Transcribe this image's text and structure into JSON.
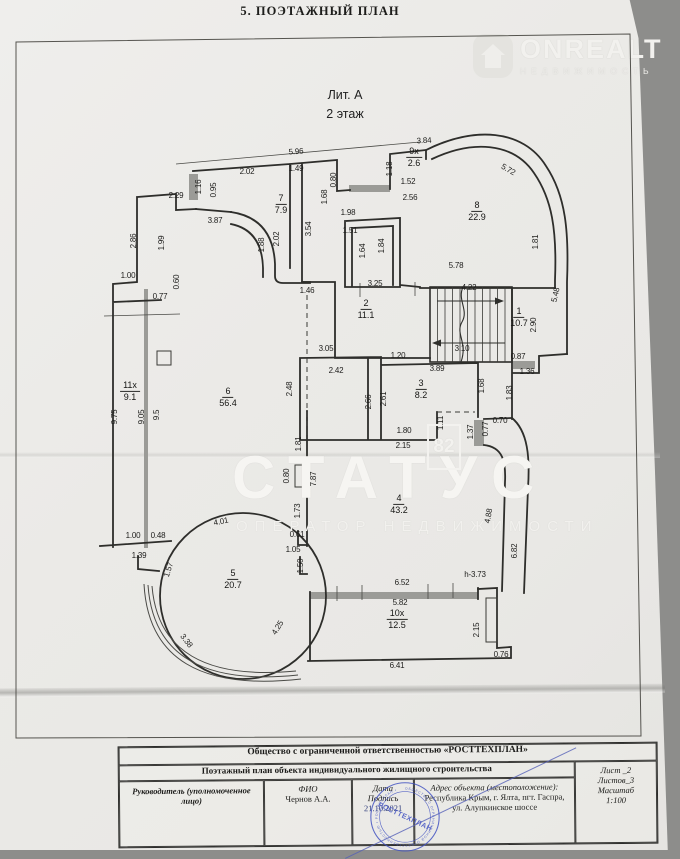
{
  "header": {
    "title": "5. ПОЭТАЖНЫЙ ПЛАН"
  },
  "watermarks": {
    "onrealt_brand": "ONREALT",
    "onrealt_sub": "НЕДВИЖИМОСТЬ",
    "status_brand": "СТАТУС",
    "status_sub": "ОПЕРАТОР НЕДВИЖИМОСТИ",
    "badge_82": "82"
  },
  "plan": {
    "litera": "Лит. А",
    "floor": "2 этаж",
    "rooms": [
      {
        "num": "1",
        "area": "10.7",
        "x": 519,
        "y": 317
      },
      {
        "num": "2",
        "area": "11.1",
        "x": 366,
        "y": 309
      },
      {
        "num": "3",
        "area": "8.2",
        "x": 421,
        "y": 389
      },
      {
        "num": "4",
        "area": "43.2",
        "x": 399,
        "y": 504
      },
      {
        "num": "5",
        "area": "20.7",
        "x": 233,
        "y": 579
      },
      {
        "num": "6",
        "area": "56.4",
        "x": 228,
        "y": 397
      },
      {
        "num": "7",
        "area": "7.9",
        "x": 281,
        "y": 204
      },
      {
        "num": "8",
        "area": "22.9",
        "x": 477,
        "y": 211
      },
      {
        "num": "9x",
        "area": "2.6",
        "x": 414,
        "y": 157
      },
      {
        "num": "10x",
        "area": "12.5",
        "x": 397,
        "y": 619
      },
      {
        "num": "11x",
        "area": "9.1",
        "x": 130,
        "y": 391
      }
    ],
    "dimensions": [
      {
        "t": "5.96",
        "x": 296,
        "y": 152,
        "r": -4
      },
      {
        "t": "3.84",
        "x": 424,
        "y": 141,
        "r": -3
      },
      {
        "t": "2.29",
        "x": 176,
        "y": 196
      },
      {
        "t": "1.16",
        "x": 199,
        "y": 187,
        "r": -90
      },
      {
        "t": "0.95",
        "x": 214,
        "y": 190,
        "r": -90
      },
      {
        "t": "2.02",
        "x": 247,
        "y": 172
      },
      {
        "t": "1.49",
        "x": 296,
        "y": 169
      },
      {
        "t": "0.80",
        "x": 334,
        "y": 180,
        "r": -90
      },
      {
        "t": "1.68",
        "x": 325,
        "y": 197,
        "r": -90
      },
      {
        "t": "1.18",
        "x": 390,
        "y": 169,
        "r": -90
      },
      {
        "t": "1.52",
        "x": 408,
        "y": 182
      },
      {
        "t": "2.56",
        "x": 410,
        "y": 198
      },
      {
        "t": "5.72",
        "x": 508,
        "y": 170,
        "r": 30
      },
      {
        "t": "3.87",
        "x": 215,
        "y": 221
      },
      {
        "t": "1.98",
        "x": 348,
        "y": 213
      },
      {
        "t": "3.54",
        "x": 309,
        "y": 229,
        "r": -90
      },
      {
        "t": "1.51",
        "x": 350,
        "y": 231
      },
      {
        "t": "1.64",
        "x": 363,
        "y": 251,
        "r": -90
      },
      {
        "t": "1.84",
        "x": 382,
        "y": 246,
        "r": -90
      },
      {
        "t": "2.86",
        "x": 134,
        "y": 241,
        "r": -90
      },
      {
        "t": "1.99",
        "x": 162,
        "y": 243,
        "r": -90
      },
      {
        "t": "1.88",
        "x": 262,
        "y": 245,
        "r": -90
      },
      {
        "t": "2.02",
        "x": 277,
        "y": 239,
        "r": -90
      },
      {
        "t": "1.81",
        "x": 536,
        "y": 242,
        "r": -90
      },
      {
        "t": "5.78",
        "x": 456,
        "y": 266
      },
      {
        "t": "5.48",
        "x": 556,
        "y": 295,
        "r": -78
      },
      {
        "t": "1.00",
        "x": 128,
        "y": 276
      },
      {
        "t": "0.60",
        "x": 177,
        "y": 282,
        "r": -90
      },
      {
        "t": "0.77",
        "x": 160,
        "y": 297
      },
      {
        "t": "3.25",
        "x": 375,
        "y": 284
      },
      {
        "t": "1.46",
        "x": 307,
        "y": 291
      },
      {
        "t": "4.22",
        "x": 469,
        "y": 288
      },
      {
        "t": "2.90",
        "x": 534,
        "y": 325,
        "r": -90
      },
      {
        "t": "3.10",
        "x": 462,
        "y": 349
      },
      {
        "t": "0.87",
        "x": 518,
        "y": 357
      },
      {
        "t": "1.36",
        "x": 527,
        "y": 372
      },
      {
        "t": "1.20",
        "x": 398,
        "y": 356
      },
      {
        "t": "3.89",
        "x": 437,
        "y": 369
      },
      {
        "t": "3.05",
        "x": 326,
        "y": 349
      },
      {
        "t": "2.42",
        "x": 336,
        "y": 371
      },
      {
        "t": "2.48",
        "x": 290,
        "y": 389,
        "r": -90
      },
      {
        "t": "2.66",
        "x": 369,
        "y": 402,
        "r": -90
      },
      {
        "t": "2.61",
        "x": 384,
        "y": 399,
        "r": -90
      },
      {
        "t": "1.68",
        "x": 482,
        "y": 386,
        "r": -90
      },
      {
        "t": "1.83",
        "x": 510,
        "y": 393,
        "r": -90
      },
      {
        "t": "1.80",
        "x": 404,
        "y": 431
      },
      {
        "t": "2.15",
        "x": 403,
        "y": 446
      },
      {
        "t": "1.11",
        "x": 441,
        "y": 423,
        "r": -90
      },
      {
        "t": "1.37",
        "x": 471,
        "y": 432,
        "r": -90
      },
      {
        "t": "0.77",
        "x": 486,
        "y": 429,
        "r": -90
      },
      {
        "t": "0.70",
        "x": 500,
        "y": 421
      },
      {
        "t": "9.75",
        "x": 115,
        "y": 417,
        "r": -90
      },
      {
        "t": "9.05",
        "x": 142,
        "y": 417,
        "r": -90
      },
      {
        "t": "9.5",
        "x": 157,
        "y": 415,
        "r": -90
      },
      {
        "t": "1.81",
        "x": 299,
        "y": 444,
        "r": -90
      },
      {
        "t": "0.80",
        "x": 287,
        "y": 476,
        "r": -90
      },
      {
        "t": "7.87",
        "x": 314,
        "y": 479,
        "r": -90
      },
      {
        "t": "1.73",
        "x": 298,
        "y": 511,
        "r": -90
      },
      {
        "t": "4.88",
        "x": 489,
        "y": 516,
        "r": -80
      },
      {
        "t": "6.82",
        "x": 515,
        "y": 551,
        "r": -90
      },
      {
        "t": "4.01",
        "x": 221,
        "y": 522,
        "r": -12
      },
      {
        "t": "1.00",
        "x": 133,
        "y": 536
      },
      {
        "t": "0.48",
        "x": 158,
        "y": 536
      },
      {
        "t": "1.39",
        "x": 139,
        "y": 556
      },
      {
        "t": "1.57",
        "x": 169,
        "y": 570,
        "r": -72
      },
      {
        "t": "0.61",
        "x": 297,
        "y": 535
      },
      {
        "t": "1.05",
        "x": 293,
        "y": 550
      },
      {
        "t": "1.50",
        "x": 301,
        "y": 566,
        "r": -90
      },
      {
        "t": "3.38",
        "x": 186,
        "y": 641,
        "r": 52
      },
      {
        "t": "4.25",
        "x": 278,
        "y": 628,
        "r": -58
      },
      {
        "t": "6.52",
        "x": 402,
        "y": 583
      },
      {
        "t": "5.82",
        "x": 400,
        "y": 603
      },
      {
        "t": "h-3.73",
        "x": 475,
        "y": 575
      },
      {
        "t": "2.15",
        "x": 477,
        "y": 630,
        "r": -90
      },
      {
        "t": "0.76",
        "x": 501,
        "y": 655
      },
      {
        "t": "6.41",
        "x": 397,
        "y": 666
      }
    ]
  },
  "footer": {
    "company": "Общество с ограниченной ответственностью «РОСТТЕХПЛАН»",
    "doc_title": "Поэтажный план объекта индивидуального жилищного строительства",
    "role_label": "Руководитель (уполномоченное лицо)",
    "fio_label": "ФИО",
    "fio_value": "Чернов А.А.",
    "date_label": "Дата",
    "sign_label": "Подпись",
    "date_value": "21.10.2021",
    "address_label": "Адрес объекта (местоположение):",
    "address_value": "Республика Крым, г. Ялта, пгт. Гаспра, ул. Алупкинское шоссе",
    "sheet": "Лист _2",
    "sheets": "Листов_3",
    "scale_label": "Масштаб",
    "scale_value": "1:100",
    "stamp_text": "РОСТТЕХПЛАН",
    "stamp_ring": "ОБЩЕСТВО С ОГРАНИЧЕННОЙ ОТВЕТСТВЕННОСТЬЮ • РОСТТЕХПЛАН •"
  }
}
